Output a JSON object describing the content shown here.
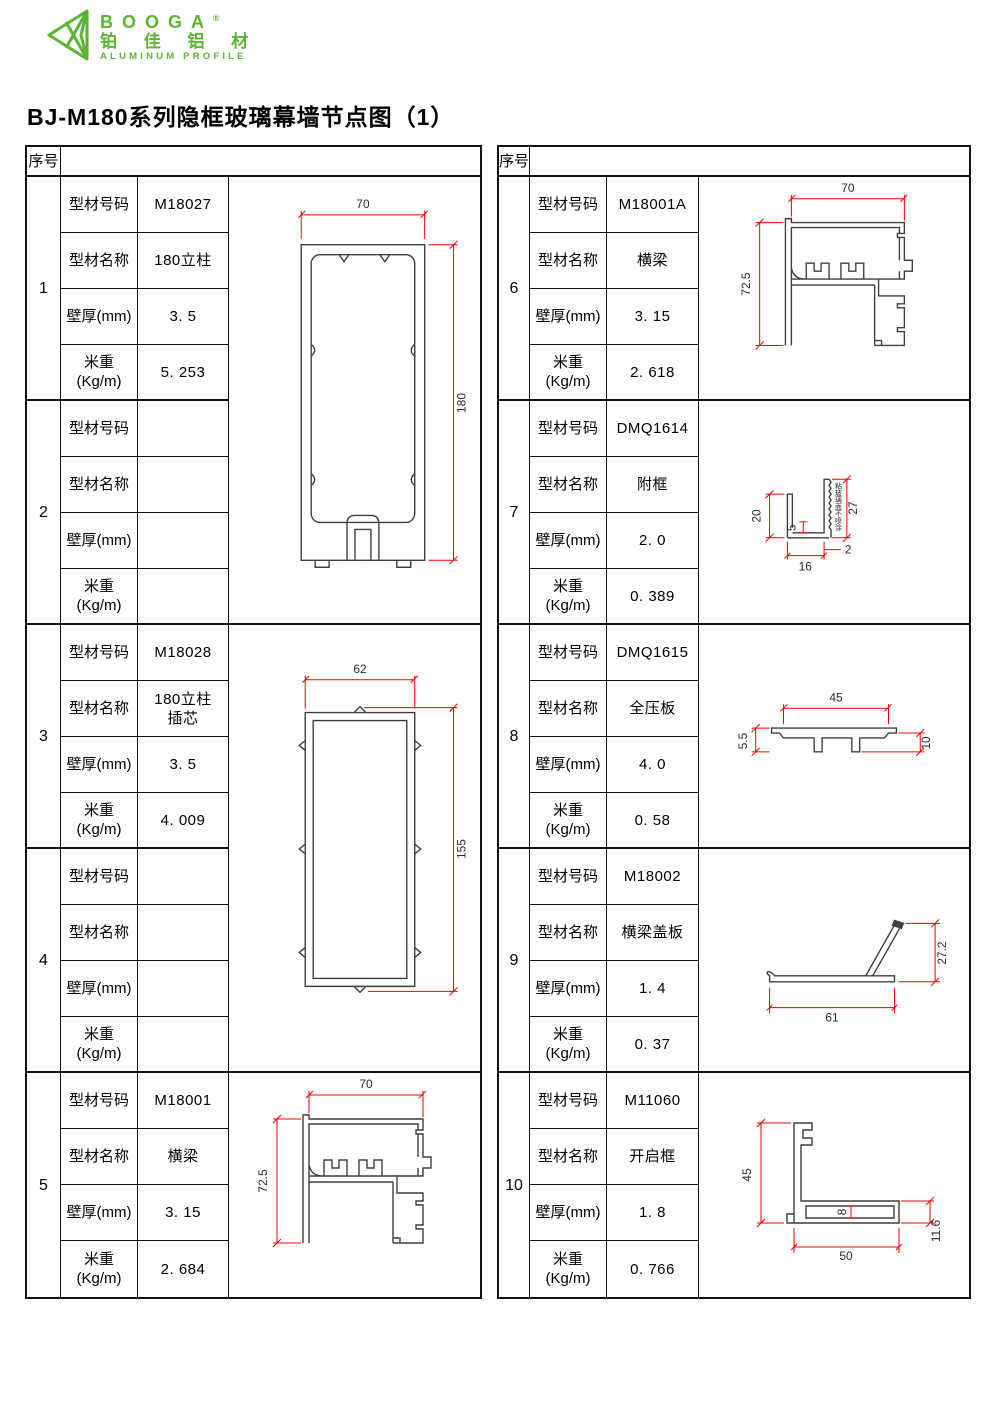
{
  "logo": {
    "brand": "BOOGA",
    "registered": "®",
    "cn": "铂 佳 铝 材",
    "en": "ALUMINUM PROFILE"
  },
  "title": "BJ-M180系列隐框玻璃幕墙节点图（1）",
  "table": {
    "serial_header": "序号",
    "field_labels": {
      "code": "型材号码",
      "name": "型材名称",
      "thickness": "壁厚(mm)",
      "weight": "米重\n(Kg/m)"
    }
  },
  "profiles": [
    {
      "no": "1",
      "code": "M18027",
      "name": "180立柱",
      "thickness": "3. 5",
      "weight": "5. 253"
    },
    {
      "no": "2",
      "code": "",
      "name": "",
      "thickness": "",
      "weight": ""
    },
    {
      "no": "3",
      "code": "M18028",
      "name": "180立柱\n插芯",
      "thickness": "3. 5",
      "weight": "4. 009"
    },
    {
      "no": "4",
      "code": "",
      "name": "",
      "thickness": "",
      "weight": ""
    },
    {
      "no": "5",
      "code": "M18001",
      "name": "横梁",
      "thickness": "3. 15",
      "weight": "2. 684"
    },
    {
      "no": "6",
      "code": "M18001A",
      "name": "横梁",
      "thickness": "3. 15",
      "weight": "2. 618"
    },
    {
      "no": "7",
      "code": "DMQ1614",
      "name": "附框",
      "thickness": "2. 0",
      "weight": "0. 389"
    },
    {
      "no": "8",
      "code": "DMQ1615",
      "name": "全压板",
      "thickness": "4. 0",
      "weight": "0. 58"
    },
    {
      "no": "9",
      "code": "M18002",
      "name": "横梁盖板",
      "thickness": "1. 4",
      "weight": "0. 37"
    },
    {
      "no": "10",
      "code": "M11060",
      "name": "开启框",
      "thickness": "1. 8",
      "weight": "0. 766"
    }
  ],
  "drawings": {
    "col180": {
      "width": "70",
      "height": "180"
    },
    "insert": {
      "width": "62",
      "height": "155"
    },
    "beam5": {
      "width": "70",
      "height": "72.5"
    },
    "beam6": {
      "width": "70",
      "height": "72.5"
    },
    "subframe": {
      "d20": "20",
      "d5": "5",
      "d16": "16",
      "d2": "2",
      "d27": "27",
      "note": "粘玻璃面不喷涂"
    },
    "pressplate": {
      "d45": "45",
      "d55": "5.5",
      "d10": "10"
    },
    "cover": {
      "d61": "61",
      "d272": "27.2"
    },
    "vent": {
      "d45": "45",
      "d8": "8",
      "d50": "50",
      "d116": "11.6"
    }
  },
  "colors": {
    "brand_green": "#5cb531",
    "dim_red": "#f20000",
    "profile_line": "#3f3f3f",
    "table_line": "#111111"
  }
}
